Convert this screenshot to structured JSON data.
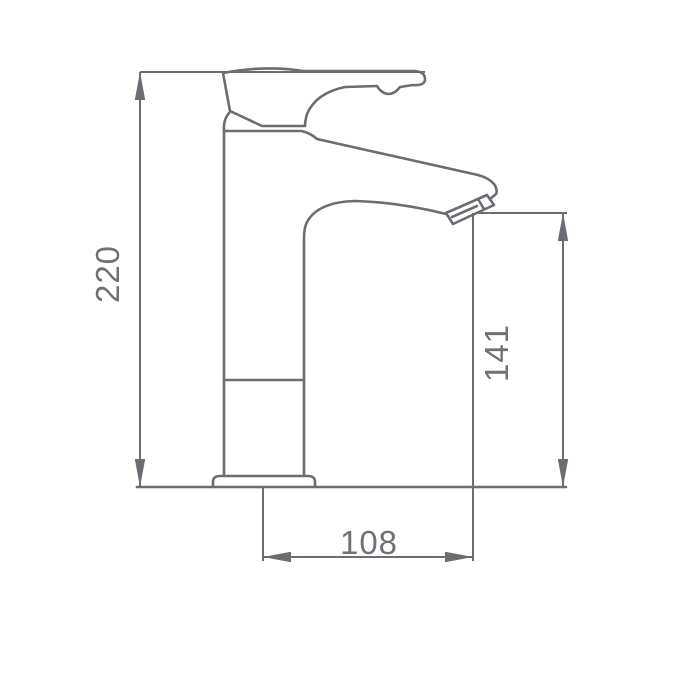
{
  "diagram": {
    "type": "technical-drawing",
    "subject": "single-lever basin mixer tap, side elevation with dimensions",
    "dimensions": {
      "overall_height": "220",
      "outlet_height": "141",
      "spout_reach": "108"
    },
    "colors": {
      "line": "#6a6d71",
      "label": "#6e7175",
      "background": "#ffffff"
    }
  }
}
